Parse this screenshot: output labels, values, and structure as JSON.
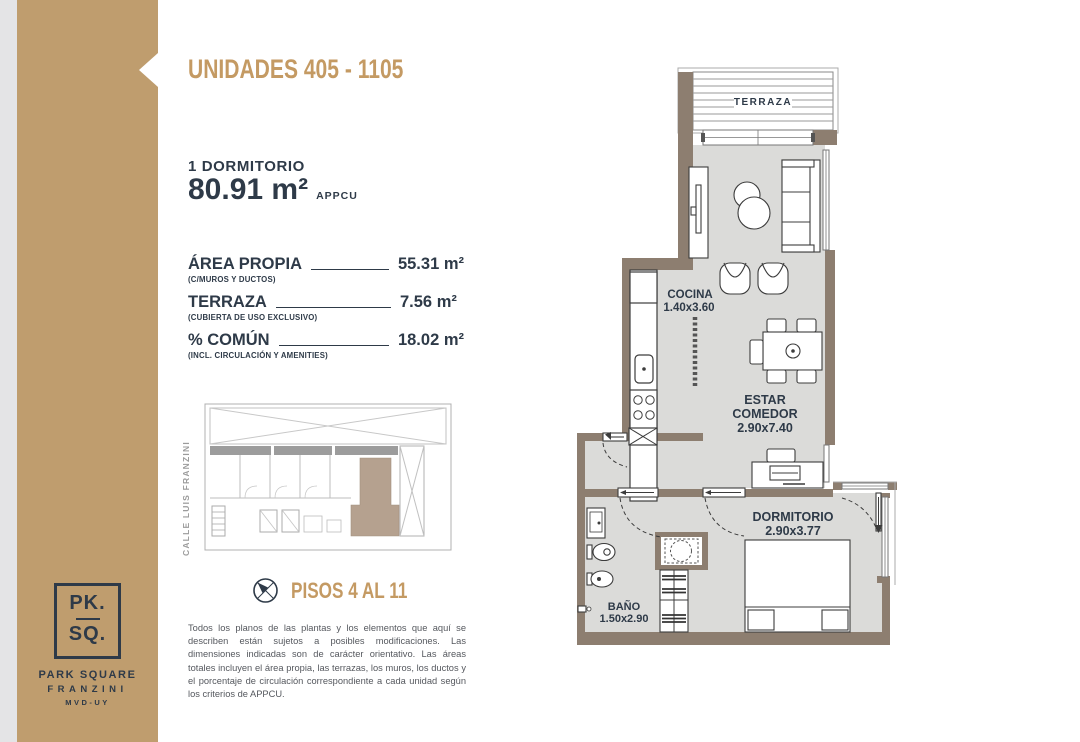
{
  "colors": {
    "sidebar_tan": "#BF9D6E",
    "accent_gold": "#C49A63",
    "navy": "#2E3A48",
    "plan_wall": "#8D7E70",
    "plan_floor": "#DBDBD9",
    "highlight_unit": "#B5A18F"
  },
  "icons": {
    "compass": "compass-icon"
  },
  "sidebar": {
    "logo": {
      "monogram_top": "PK.",
      "monogram_bottom": "SQ.",
      "brand": "PARK SQUARE",
      "brand_sub": "FRANZINI",
      "location": "MVD-UY"
    }
  },
  "header": {
    "title": "UNIDADES 405 - 1105"
  },
  "summary": {
    "bedrooms": "1 DORMITORIO",
    "total_area": "80.91 m²",
    "standard": "APPCU"
  },
  "areas": [
    {
      "label": "ÁREA PROPIA",
      "note": "(C/MUROS Y DUCTOS)",
      "value": "55.31 m²"
    },
    {
      "label": "TERRAZA",
      "note": "(CUBIERTA DE USO EXCLUSIVO)",
      "value": "7.56 m²"
    },
    {
      "label": "% COMÚN",
      "note": "(INCL. CIRCULACIÓN Y AMENITIES)",
      "value": "18.02 m²"
    }
  ],
  "site_plan": {
    "street": "CALLE LUIS FRANZINI"
  },
  "floors": {
    "label": "PISOS 4 AL 11"
  },
  "disclaimer": "Todos los planos de las plantas y los elementos que aquí se describen están sujetos a posibles modificaciones. Las dimensiones indicadas son de carácter orientativo. Las áreas totales incluyen el área propia, las terrazas, los muros, los ductos y el porcentaje de circulación correspondiente a cada unidad según los criterios de APPCU.",
  "plan": {
    "terraza": "TERRAZA",
    "cocina": "COCINA",
    "cocina_dims": "1.40x3.60",
    "estar_1": "ESTAR",
    "estar_2": "COMEDOR",
    "estar_dims": "2.90x7.40",
    "dormitorio": "DORMITORIO",
    "dormitorio_dims": "2.90x3.77",
    "bano": "BAÑO",
    "bano_dims": "1.50x2.90"
  }
}
